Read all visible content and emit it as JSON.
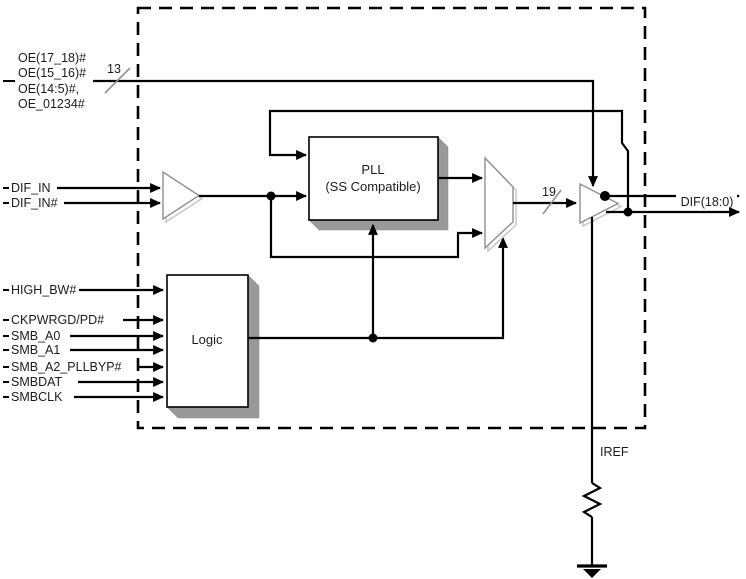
{
  "diagram": {
    "kind": "clock-buffer-block-diagram",
    "colors": {
      "line": "#000000",
      "block_shadow": "#999999",
      "buffer_outline": "#8f8f8f",
      "background": "#ffffff"
    },
    "oe_pin_group": {
      "labels": [
        "OE(17_18)#",
        "OE(15_16)#",
        "OE(14:5)#,",
        "OE_01234#"
      ],
      "bus_width": "13"
    },
    "left_pins": {
      "dif_in": "DIF_IN",
      "dif_in_n": "DIF_IN#",
      "high_bw": "HIGH_BW#",
      "ckpwrgd_pd": "CKPWRGD/PD#",
      "smb_a0": "SMB_A0",
      "smb_a1": "SMB_A1",
      "smb_a2_pllbyp": "SMB_A2_PLLBYP#",
      "smbdat": "SMBDAT",
      "smbclk": "SMBCLK"
    },
    "blocks": {
      "pll_title": "PLL",
      "pll_subtitle": "(SS Compatible)",
      "logic": "Logic"
    },
    "output": {
      "bus_width": "19",
      "label": "DIF(18:0)"
    },
    "iref": "IREF"
  }
}
